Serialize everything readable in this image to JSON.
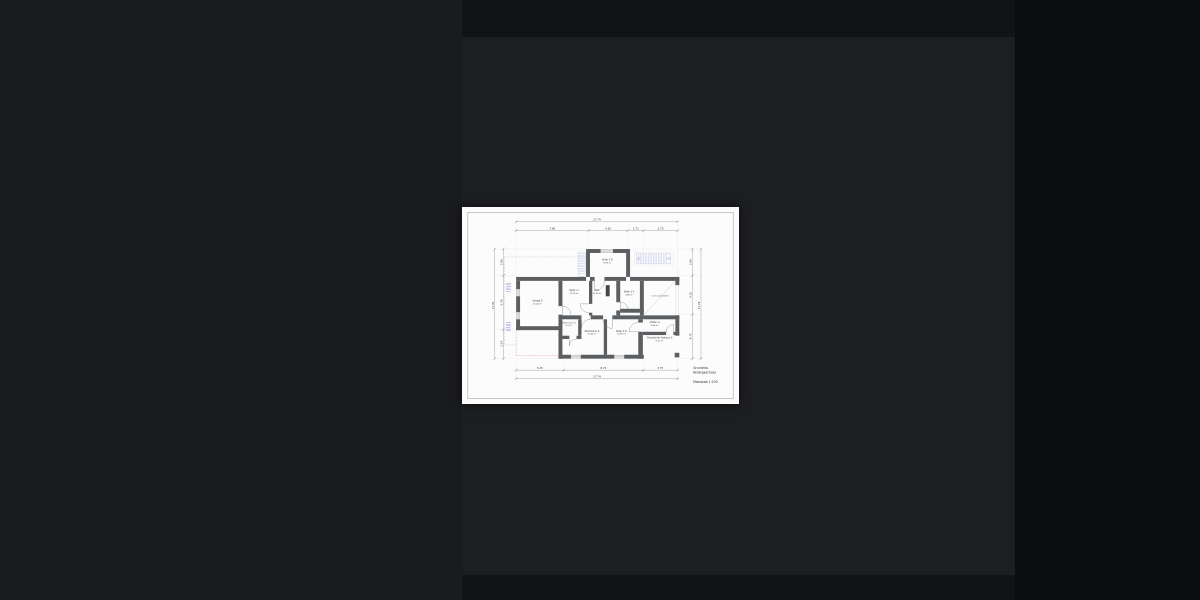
{
  "viewer": {
    "description": "dark image viewer showing a floor plan page",
    "colors": {
      "left_panel": "#1a1b1d",
      "center_panel": "#1d1e20",
      "right_panel": "#0c0d0f",
      "top_band": "#121317",
      "bottom_band": "#121317",
      "page": "#fcfcfc"
    }
  },
  "plan": {
    "title_block": {
      "line1": "Grundriss",
      "line2": "Kellergeschoss",
      "scale": "Massstab 1:100"
    },
    "annotation": "nicht unterkellert",
    "rooms": [
      {
        "name": "Garage G",
        "area": "23.24 m²"
      },
      {
        "name": "Keller 1 I",
        "area": "12.14 m²"
      },
      {
        "name": "Flur",
        "area": "13.05 m²"
      },
      {
        "name": "Keller 3 III",
        "area": "9.09 m²"
      },
      {
        "name": "Keller 2 II",
        "area": "5.86 m²"
      },
      {
        "name": "Abstell. G",
        "area": "4.44 m²"
      },
      {
        "name": "Überdachter Freiraum G",
        "area": "9.27 m²"
      },
      {
        "name": "Waschraum G",
        "area": "12.40 m²"
      },
      {
        "name": "Keller 4 IV",
        "area": "13.90 m²"
      },
      {
        "name": "Räderraum G",
        "area": "4.1 m²"
      }
    ],
    "dimensions": {
      "top": {
        "overall": "17.74",
        "segments": [
          "7.96",
          "4.30",
          "1.73",
          "3.75"
        ]
      },
      "bottom": {
        "overall": "17.74",
        "segments": [
          "5.25",
          "8.74",
          "3.75"
        ]
      },
      "left": {
        "overall": "11.76",
        "segments": [
          "2.86",
          "5.76",
          "3.14"
        ]
      },
      "right": {
        "overall": "11.76",
        "segments": [
          "2.86",
          "4.15",
          "4.75"
        ]
      }
    },
    "colors": {
      "wall": "#5c5f62",
      "chimney": "#474747",
      "accent_blue": "#4f59c7",
      "accent_red": "#d06060",
      "dash_gray": "#b0b0b0"
    }
  }
}
